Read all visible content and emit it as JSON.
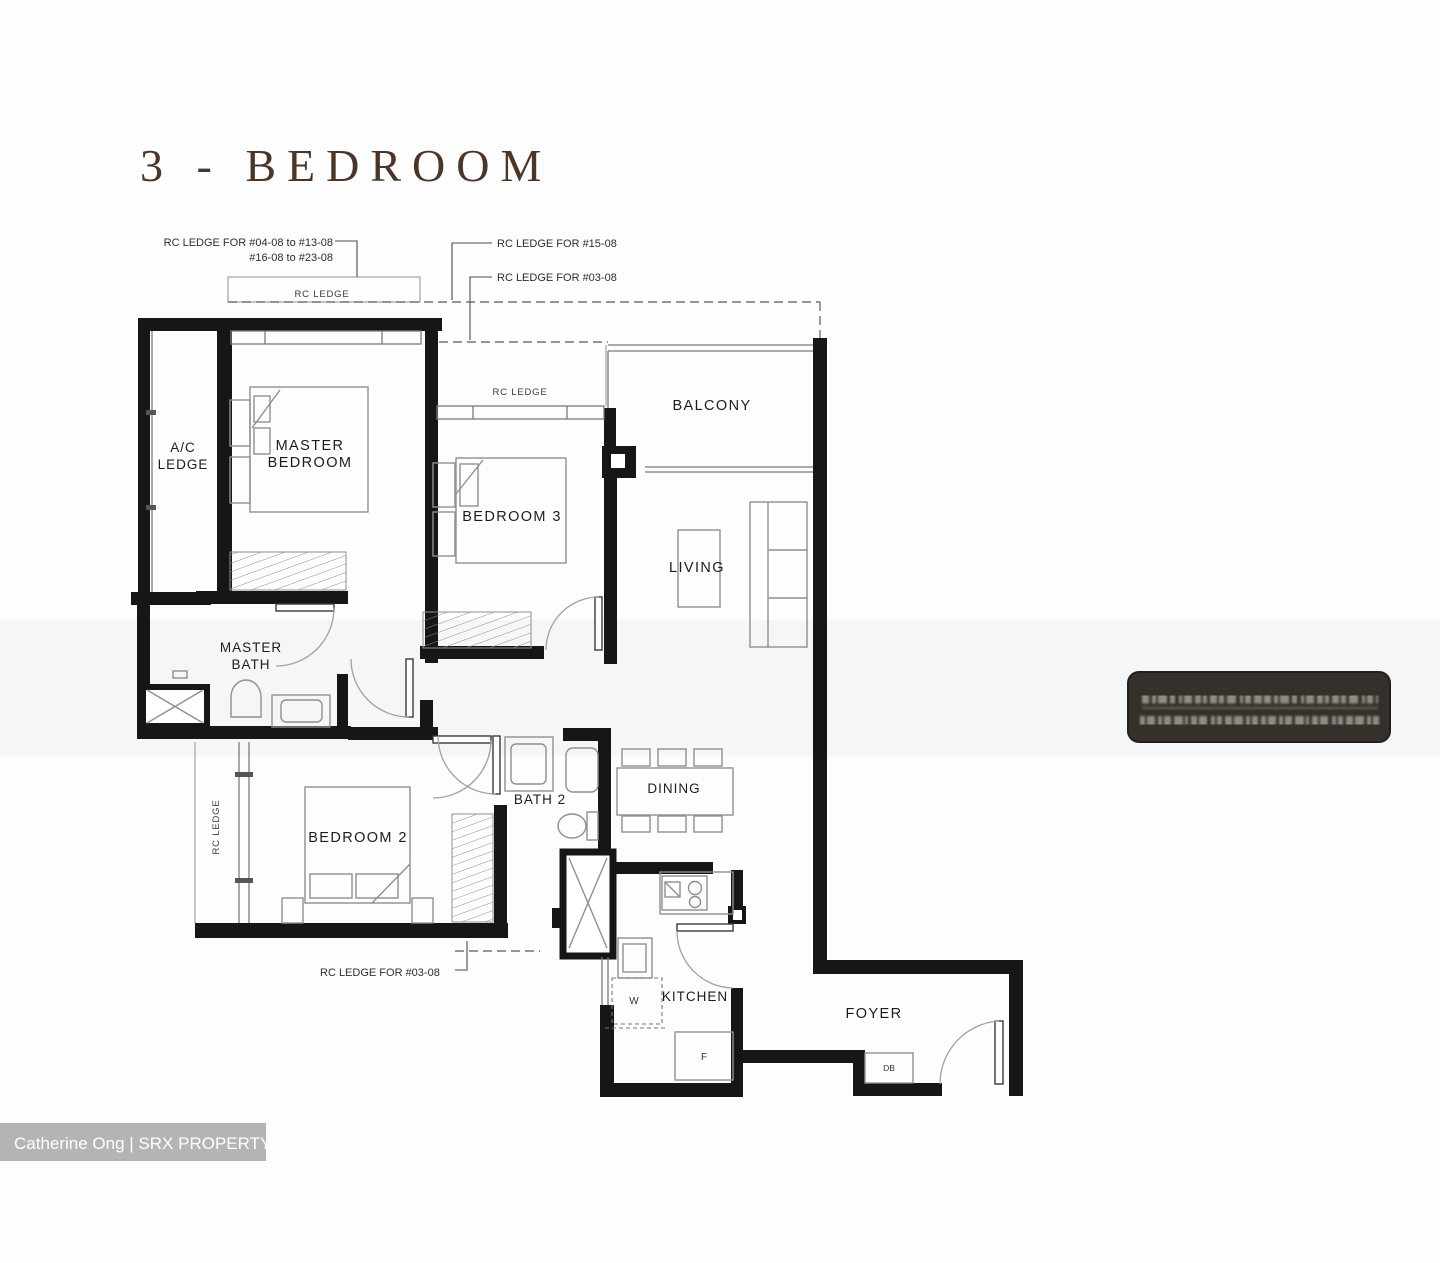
{
  "title": "3 - BEDROOM",
  "rooms": {
    "ac_ledge": {
      "line1": "A/C",
      "line2": "LEDGE"
    },
    "master_bedroom": {
      "line1": "MASTER",
      "line2": "BEDROOM"
    },
    "bedroom3": {
      "label": "BEDROOM 3"
    },
    "balcony": {
      "label": "BALCONY"
    },
    "living": {
      "label": "LIVING"
    },
    "master_bath": {
      "line1": "MASTER",
      "line2": "BATH"
    },
    "bedroom2": {
      "label": "BEDROOM 2"
    },
    "bath2": {
      "label": "BATH 2"
    },
    "dining": {
      "label": "DINING"
    },
    "kitchen": {
      "label": "KITCHEN"
    },
    "foyer": {
      "label": "FOYER"
    }
  },
  "annotations": {
    "ledge_units_top_a": "RC LEDGE FOR #04-08 to #13-08",
    "ledge_units_top_b": "#16-08 to #23-08",
    "ledge_unit_15": "RC LEDGE FOR #15-08",
    "ledge_unit_03_top": "RC LEDGE FOR #03-08",
    "ledge_unit_03_bottom": "RC LEDGE FOR #03-08",
    "rc_ledge_master": "RC LEDGE",
    "rc_ledge_bedroom3": "RC LEDGE",
    "rc_ledge_bedroom2": "RC LEDGE"
  },
  "appliances": {
    "washer": "W",
    "fridge": "F",
    "distribution_board": "DB"
  },
  "watermark": "Catherine Ong | SRX PROPERTY",
  "colors": {
    "wall": "#161616",
    "title_text": "#4b3527",
    "furniture_line": "#8f8f8f",
    "stamp_bg": "#35302b",
    "watermark_bg": "#b0b0b0"
  }
}
